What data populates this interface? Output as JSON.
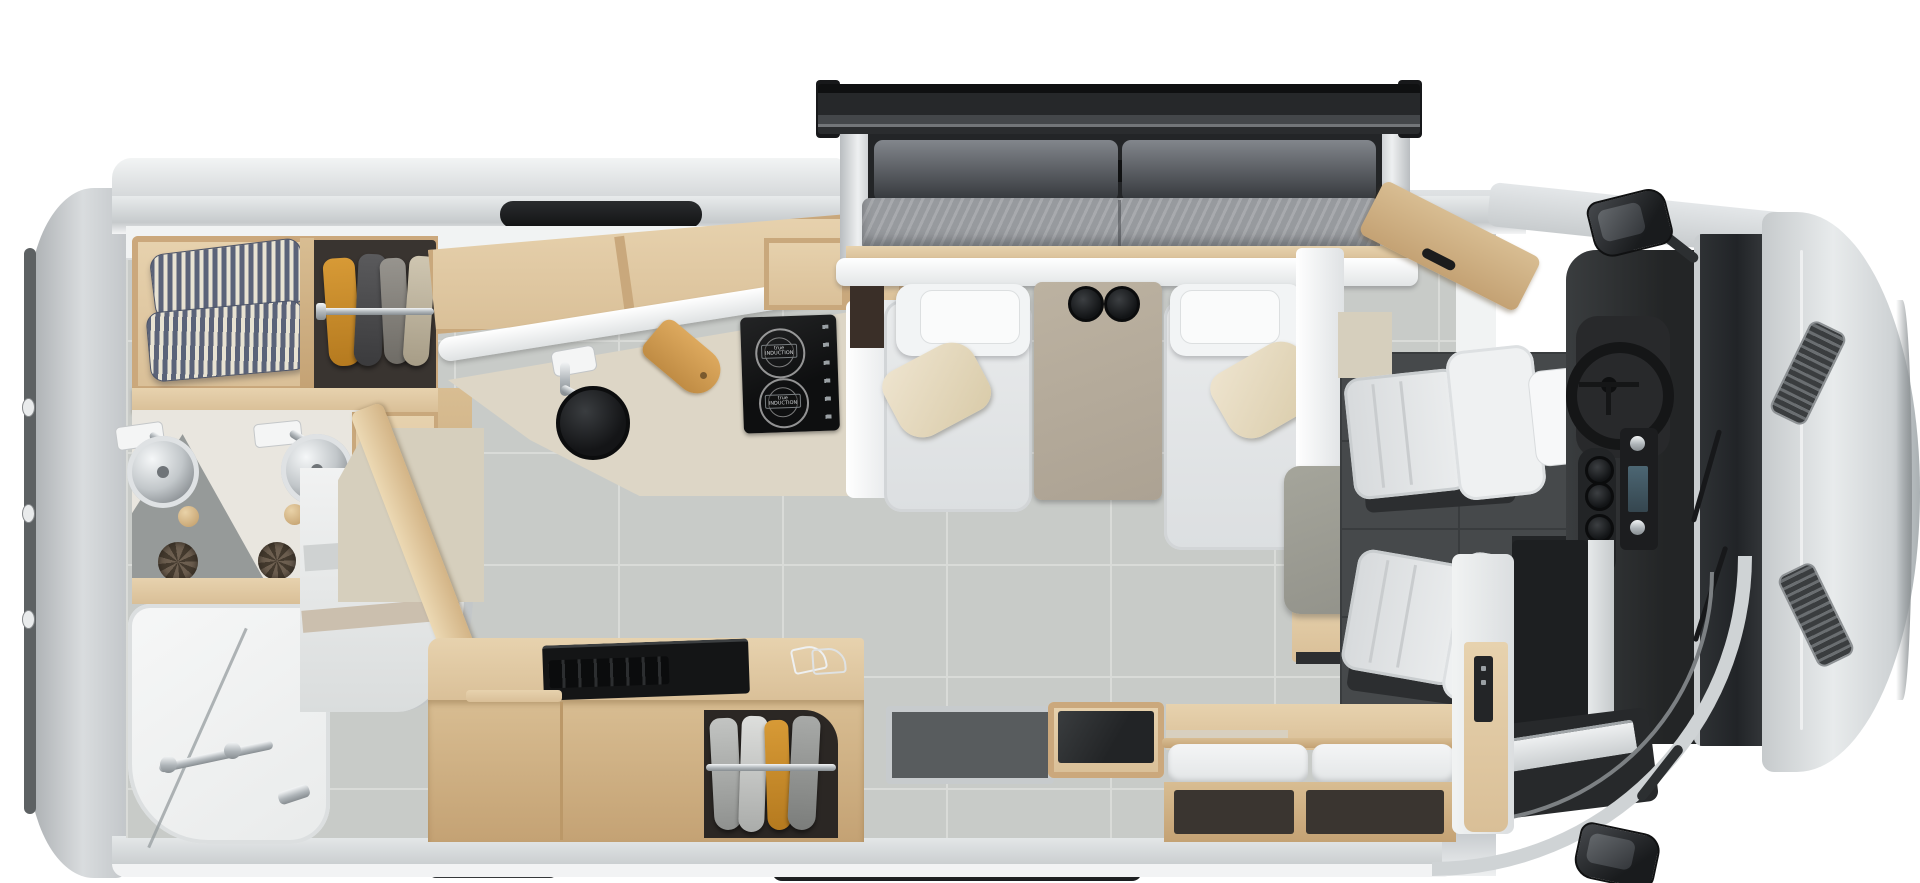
{
  "scene": {
    "description": "Top-down cutaway floor plan rendering of a Class B+ motorhome with rear bathroom, murphy-bed slide-out lounge and drivers cab",
    "palette": {
      "body_silver": "#c9cdd0",
      "body_highlight": "#e8ebec",
      "interior_wall_white": "#f1f3f3",
      "floor_tile_gray": "#c8cbc8",
      "cab_floor_dark": "#46494b",
      "wood_light": "#e7d2ae",
      "wood_mid": "#d9bf97",
      "mattress_gray": "#979a9e",
      "sofa_back_dark": "#3e4145",
      "recliner_white": "#f2f4f5",
      "pillow_cream": "#e8dfc9",
      "table_taupe": "#b4aa99",
      "pedestal_table_gray": "#9c9c92",
      "counter_stone": "#ddd6c6",
      "cooktop_black": "#141516",
      "ticking_stripe_navy": "#5b6379",
      "garment_orange": "#c98f2e",
      "chrome": "#b9bec2",
      "topper_black": "#202224"
    }
  },
  "cooktop": {
    "brand_line1": "true",
    "brand_line2": "INDUCTION",
    "burners": 2
  },
  "fixtures": {
    "bathroom_sinks": 2,
    "recliners": 2,
    "cab_seats": 2,
    "cupholders_table": 2,
    "cupholders_console": 4
  }
}
